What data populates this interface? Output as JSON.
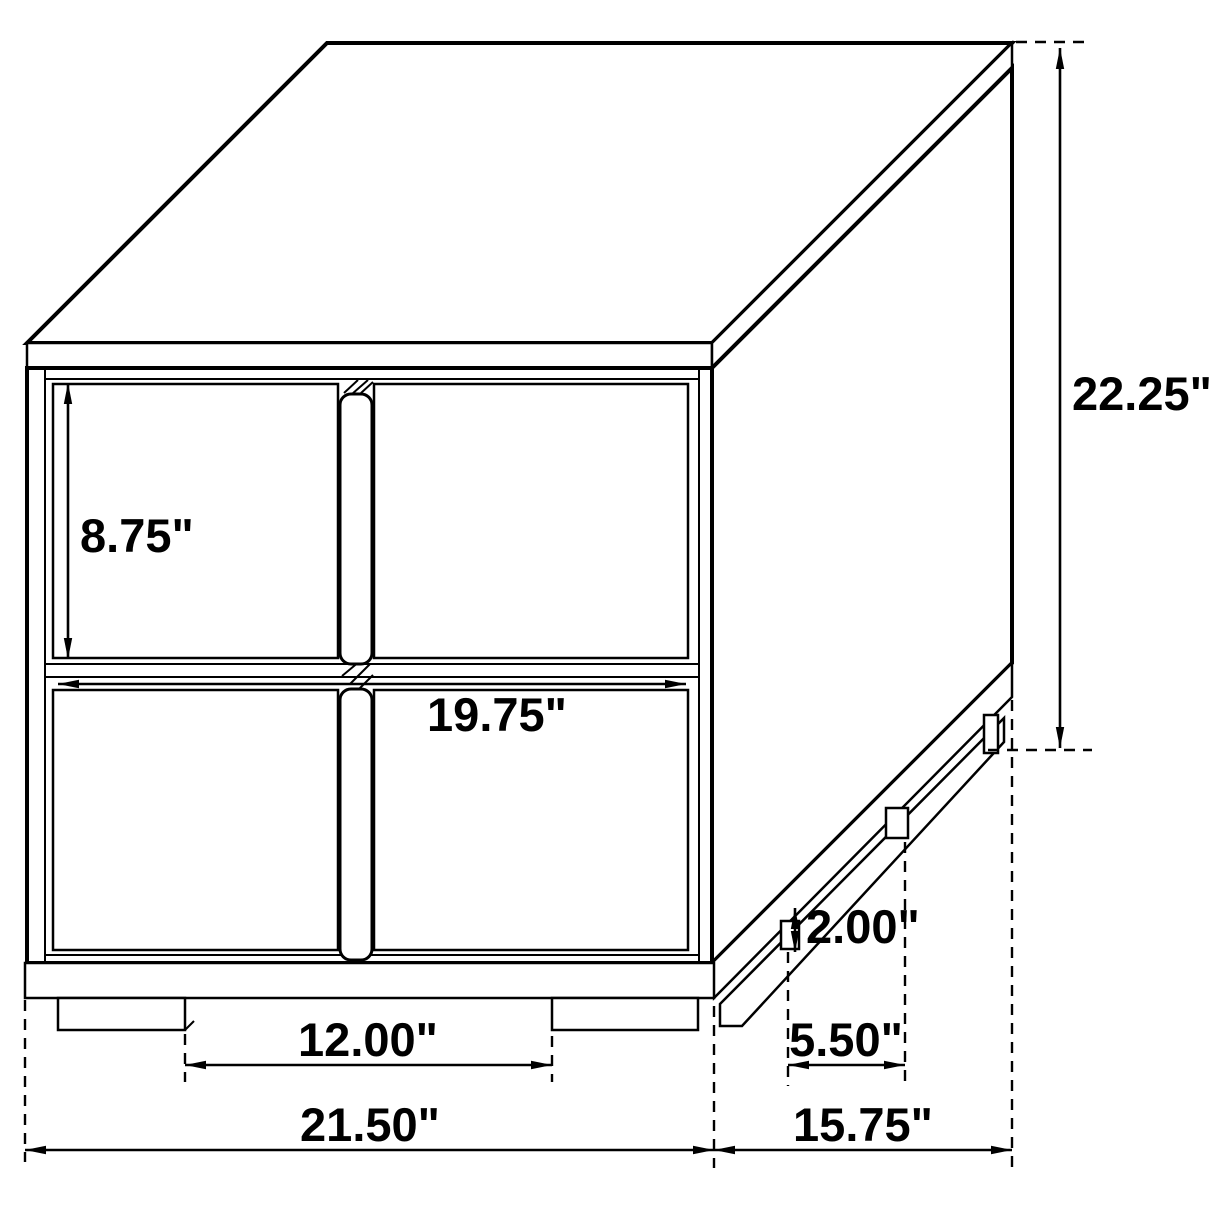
{
  "diagram": {
    "type": "furniture-dimension-drawing",
    "subject": "two-drawer nightstand isometric line drawing",
    "background_color": "#ffffff",
    "line_color": "#000000",
    "labels": {
      "drawer_face_height": "8.75\"",
      "drawer_face_width": "19.75\"",
      "overall_height": "22.25\"",
      "front_feet_spacing": "12.00\"",
      "overall_width": "21.50\"",
      "base_height": "2.00\"",
      "side_feet_spacing": "5.50\"",
      "overall_depth": "15.75\""
    }
  }
}
